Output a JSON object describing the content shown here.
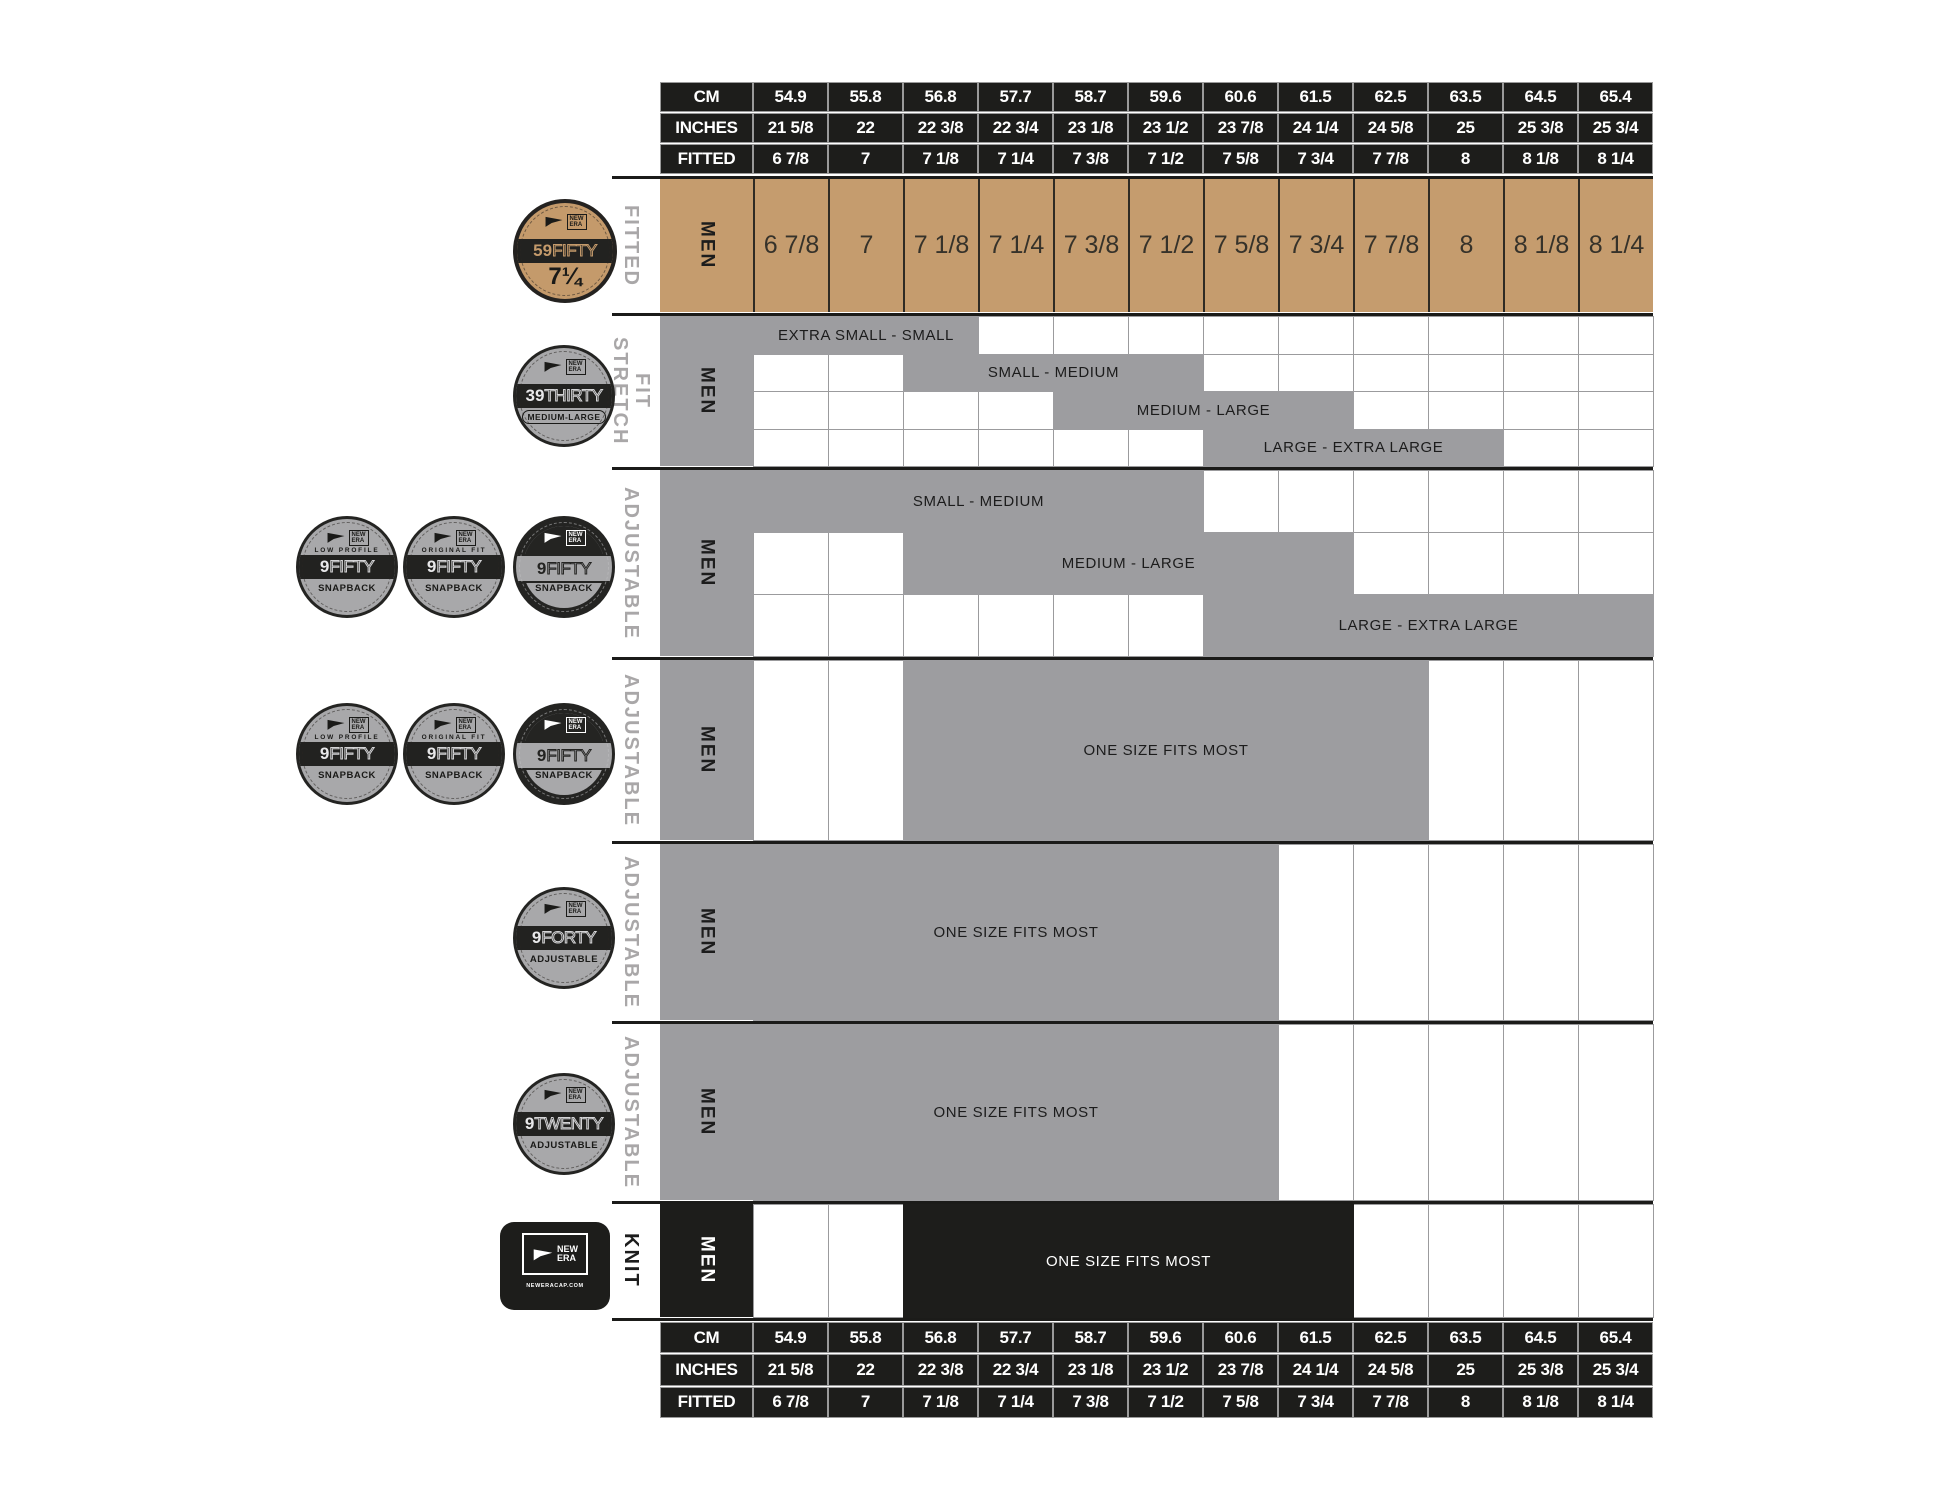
{
  "colors": {
    "tan": "#c59c6e",
    "gray": "#9d9da0",
    "black": "#1d1d1b",
    "badge_gray": "#a8a8aa"
  },
  "table": {
    "row_labels": {
      "cm": "CM",
      "inches": "INCHES",
      "fitted": "FITTED"
    },
    "men_label": "MEN",
    "cm": [
      "54.9",
      "55.8",
      "56.8",
      "57.7",
      "58.7",
      "59.6",
      "60.6",
      "61.5",
      "62.5",
      "63.5",
      "64.5",
      "65.4"
    ],
    "inches": [
      "21 5/8",
      "22",
      "22 3/8",
      "22 3/4",
      "23 1/8",
      "23 1/2",
      "23 7/8",
      "24 1/4",
      "24 5/8",
      "25",
      "25 3/8",
      "25 3/4"
    ],
    "fitted": [
      "6 7/8",
      "7",
      "7 1/8",
      "7 1/4",
      "7 3/8",
      "7 1/2",
      "7 5/8",
      "7 3/4",
      "7 7/8",
      "8",
      "8 1/8",
      "8 1/4"
    ]
  },
  "sections": [
    {
      "id": "fitted",
      "label": "FITTED",
      "type": "sizes"
    },
    {
      "id": "stretch-fit",
      "label": "STRETCH\nFIT",
      "bars": [
        {
          "label": "EXTRA SMALL - SMALL",
          "start": 1,
          "span": 3
        },
        {
          "label": "SMALL - MEDIUM",
          "start": 3,
          "span": 4
        },
        {
          "label": "MEDIUM - LARGE",
          "start": 5,
          "span": 4
        },
        {
          "label": "LARGE - EXTRA LARGE",
          "start": 7,
          "span": 4
        }
      ]
    },
    {
      "id": "adjustable-9fifty-a",
      "label": "ADJUSTABLE",
      "bars": [
        {
          "label": "SMALL - MEDIUM",
          "start": 1,
          "span": 6
        },
        {
          "label": "MEDIUM - LARGE",
          "start": 3,
          "span": 6
        },
        {
          "label": "LARGE - EXTRA LARGE",
          "start": 7,
          "span": 6
        }
      ]
    },
    {
      "id": "adjustable-9fifty-b",
      "label": "ADJUSTABLE",
      "bars": [
        {
          "label": "ONE SIZE FITS MOST",
          "start": 3,
          "span": 7
        }
      ]
    },
    {
      "id": "adjustable-9forty",
      "label": "ADJUSTABLE",
      "bars": [
        {
          "label": "ONE SIZE FITS MOST",
          "start": 1,
          "span": 7
        }
      ]
    },
    {
      "id": "adjustable-9twenty",
      "label": "ADJUSTABLE",
      "bars": [
        {
          "label": "ONE SIZE FITS MOST",
          "start": 1,
          "span": 7
        }
      ]
    },
    {
      "id": "knit",
      "label": "KNIT",
      "bars": [
        {
          "label": "ONE SIZE FITS MOST",
          "start": 3,
          "span": 6,
          "style": "black"
        }
      ]
    }
  ],
  "logo": {
    "line1": "NEW",
    "line2": "ERA"
  },
  "badges": {
    "b59fifty": {
      "style": "tan",
      "arc": "",
      "num": "59",
      "rest": "FIFTY",
      "size": "7¼"
    },
    "b39thirty": {
      "style": "gray",
      "arc": "",
      "num": "39",
      "rest": "THIRTY",
      "bottom": "MEDIUM-LARGE",
      "boxed": true
    },
    "b9fifty_low": {
      "style": "gray",
      "arc": "LOW PROFILE",
      "num": "9",
      "rest": "FIFTY",
      "bottom": "SNAPBACK"
    },
    "b9fifty_orig": {
      "style": "gray",
      "arc": "ORIGINAL FIT",
      "num": "9",
      "rest": "FIFTY",
      "bottom": "SNAPBACK"
    },
    "b9fifty": {
      "style": "dark",
      "arc": "",
      "num": "9",
      "rest": "FIFTY",
      "bottom": "SNAPBACK"
    },
    "b9forty": {
      "style": "gray",
      "arc": "",
      "num": "9",
      "rest": "FORTY",
      "bottom": "ADJUSTABLE"
    },
    "b9twenty": {
      "style": "gray",
      "arc": "",
      "num": "9",
      "rest": "TWENTY",
      "bottom": "ADJUSTABLE"
    },
    "knit": {
      "url": "NEWERACAP.COM"
    }
  },
  "chart_data": {
    "type": "table",
    "title": "New Era cap size chart (MEN)",
    "columns_cm": [
      "54.9",
      "55.8",
      "56.8",
      "57.7",
      "58.7",
      "59.6",
      "60.6",
      "61.5",
      "62.5",
      "63.5",
      "64.5",
      "65.4"
    ],
    "columns_inches": [
      "21 5/8",
      "22",
      "22 3/8",
      "22 3/4",
      "23 1/8",
      "23 1/2",
      "23 7/8",
      "24 1/4",
      "24 5/8",
      "25",
      "25 3/8",
      "25 3/4"
    ],
    "columns_fitted": [
      "6 7/8",
      "7",
      "7 1/8",
      "7 1/4",
      "7 3/8",
      "7 1/2",
      "7 5/8",
      "7 3/4",
      "7 7/8",
      "8",
      "8 1/8",
      "8 1/4"
    ],
    "products": [
      {
        "name": "59FIFTY",
        "fit": "FITTED",
        "gender": "MEN",
        "coverage": "each fitted size 6 7/8 through 8 1/4"
      },
      {
        "name": "39THIRTY",
        "fit": "STRETCH FIT",
        "gender": "MEN",
        "ranges": [
          {
            "label": "EXTRA SMALL - SMALL",
            "fitted_from": "6 7/8",
            "fitted_to": "7 1/8"
          },
          {
            "label": "SMALL - MEDIUM",
            "fitted_from": "7 1/8",
            "fitted_to": "7 1/2"
          },
          {
            "label": "MEDIUM - LARGE",
            "fitted_from": "7 3/8",
            "fitted_to": "7 3/4"
          },
          {
            "label": "LARGE - EXTRA LARGE",
            "fitted_from": "7 5/8",
            "fitted_to": "8"
          }
        ]
      },
      {
        "name": "9FIFTY SNAPBACK (LOW PROFILE / ORIGINAL FIT / 9FIFTY)",
        "fit": "ADJUSTABLE",
        "gender": "MEN",
        "ranges": [
          {
            "label": "SMALL - MEDIUM",
            "fitted_from": "6 7/8",
            "fitted_to": "7 1/2"
          },
          {
            "label": "MEDIUM - LARGE",
            "fitted_from": "7 1/8",
            "fitted_to": "7 3/4"
          },
          {
            "label": "LARGE - EXTRA LARGE",
            "fitted_from": "7 5/8",
            "fitted_to": "8 1/4"
          }
        ]
      },
      {
        "name": "9FIFTY SNAPBACK one-size",
        "fit": "ADJUSTABLE",
        "gender": "MEN",
        "ranges": [
          {
            "label": "ONE SIZE FITS MOST",
            "fitted_from": "7 1/8",
            "fitted_to": "7 7/8"
          }
        ]
      },
      {
        "name": "9FORTY",
        "fit": "ADJUSTABLE",
        "gender": "MEN",
        "ranges": [
          {
            "label": "ONE SIZE FITS MOST",
            "fitted_from": "6 7/8",
            "fitted_to": "7 5/8"
          }
        ]
      },
      {
        "name": "9TWENTY",
        "fit": "ADJUSTABLE",
        "gender": "MEN",
        "ranges": [
          {
            "label": "ONE SIZE FITS MOST",
            "fitted_from": "6 7/8",
            "fitted_to": "7 5/8"
          }
        ]
      },
      {
        "name": "NEW ERA KNIT",
        "fit": "KNIT",
        "gender": "MEN",
        "ranges": [
          {
            "label": "ONE SIZE FITS MOST",
            "fitted_from": "7 1/8",
            "fitted_to": "7 3/4"
          }
        ]
      }
    ]
  }
}
